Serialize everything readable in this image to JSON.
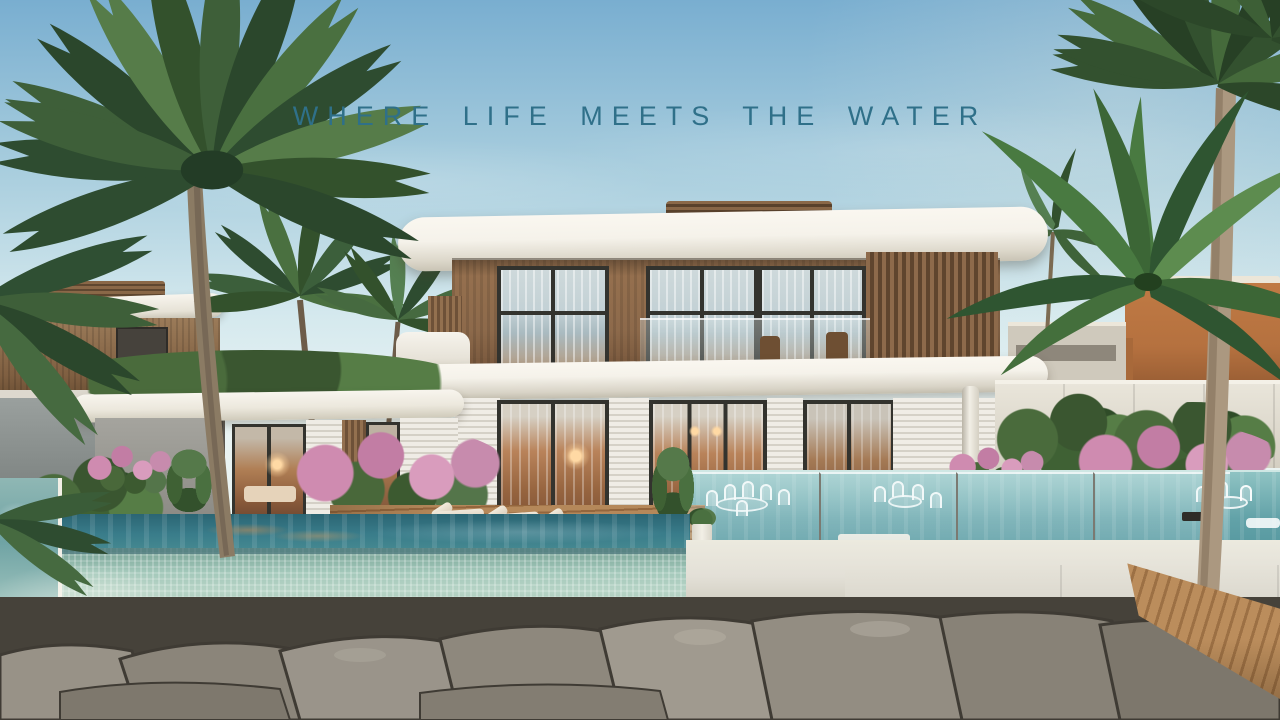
{
  "hero": {
    "tagline": "WHERE LIFE MEETS THE WATER"
  },
  "palette": {
    "sky_top": "#79aed0",
    "sky_mid": "#a9cede",
    "sky_low": "#d5e9ee",
    "sky_horizon": "#eaf4f3",
    "tagline": "#2f7089",
    "roof_white": "#f5f2ea",
    "roof_shade": "#c9c4b5",
    "wood": "#8d6a4b",
    "wood_dark": "#654830",
    "frame": "#33332e",
    "glass_cool": "#c3d1d5",
    "interior_warm": "#b9835a",
    "interior_deep": "#7c4f34",
    "lamp": "#ffd9a4",
    "louver_light": "#f0ede6",
    "louver_shade": "#d5d1c7",
    "pool_far": "#62a2a8",
    "pool_near": "#397c8a",
    "pool_deep": "#2b6573",
    "tile": "#a3c8ba",
    "ledge": "#d8d5cb",
    "ledge_shade": "#bfbbaf",
    "rock": "#918b80",
    "rock_dark": "#46423a",
    "palm": "#3e5f39",
    "palm_dark": "#2b472c",
    "palm_light": "#567c49",
    "trunk": "#8b7b64",
    "trunk_light": "#ab9880",
    "deck": "#b5885a",
    "deck_dark": "#94663d",
    "pink": "#cf8bb0",
    "bush": "#3f6134",
    "fence_white": "#e9e5da",
    "gray_wall": "#9aa09e",
    "orange_bldg": "#b5713f",
    "white_wall": "#e3e0d7"
  }
}
